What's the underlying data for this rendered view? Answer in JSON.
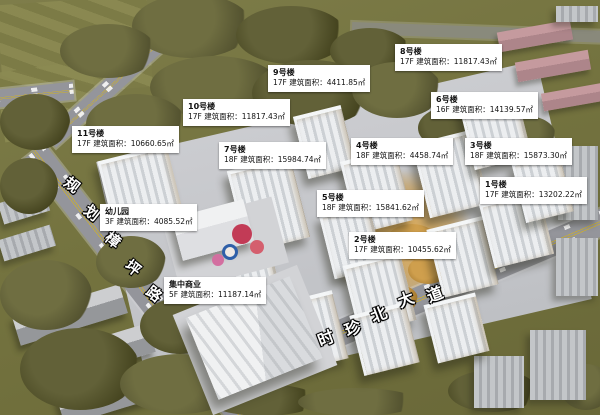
{
  "palette": {
    "terrain_green": "#74733f",
    "tree_dark": "#545330",
    "road_gray": "#94959b",
    "road_centerline_yellow": "#c9ae35",
    "development_ground": "#c5c6ca",
    "building_white": "#eceef0",
    "courtyard_warm": "#c79b4f",
    "label_background": "#ffffff",
    "label_text": "#111111"
  },
  "roads": {
    "left_name": "规划樟坪路",
    "left_name_chars": [
      "规",
      "划",
      "樟",
      "坪",
      "路"
    ],
    "bottom_name": "时珍北大道",
    "bottom_name_chars": [
      "时",
      "珍",
      "北",
      "大",
      "道"
    ]
  },
  "labels": [
    {
      "name": "8号楼",
      "detail": "17F 建筑面积：11817.43㎡"
    },
    {
      "name": "9号楼",
      "detail": "17F 建筑面积：4411.85㎡"
    },
    {
      "name": "10号楼",
      "detail": "17F 建筑面积：11817.43㎡"
    },
    {
      "name": "6号楼",
      "detail": "16F 建筑面积：14139.57㎡"
    },
    {
      "name": "11号楼",
      "detail": "17F 建筑面积：10660.65㎡"
    },
    {
      "name": "7号楼",
      "detail": "18F 建筑面积：15984.74㎡"
    },
    {
      "name": "4号楼",
      "detail": "18F 建筑面积：4458.74㎡"
    },
    {
      "name": "3号楼",
      "detail": "18F 建筑面积：15873.30㎡"
    },
    {
      "name": "5号楼",
      "detail": "18F 建筑面积：15841.62㎡"
    },
    {
      "name": "1号楼",
      "detail": "17F 建筑面积：13202.22㎡"
    },
    {
      "name": "幼儿园",
      "detail": "3F 建筑面积：4085.52㎡"
    },
    {
      "name": "2号楼",
      "detail": "17F 建筑面积：10455.62㎡"
    },
    {
      "name": "集中商业",
      "detail": "5F 建筑面积：11187.14㎡"
    }
  ]
}
